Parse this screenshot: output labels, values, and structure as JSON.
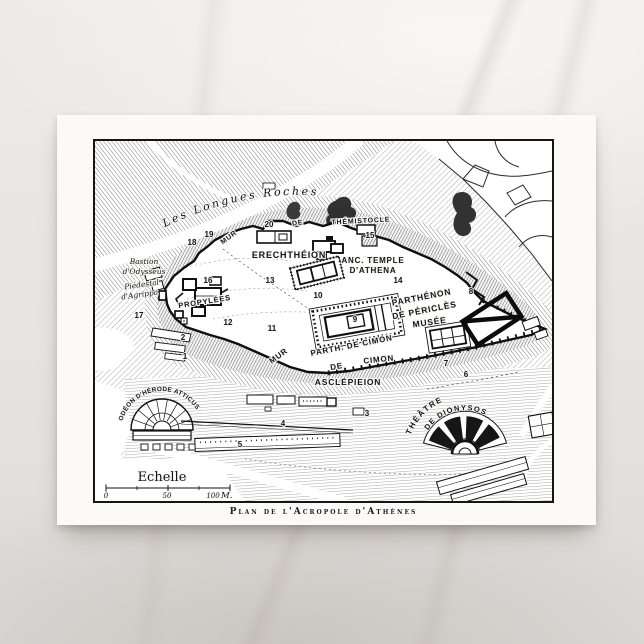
{
  "colors": {
    "marble": "#e6e3e0",
    "card": "#fbfaf7",
    "ink": "#161616"
  },
  "postcard": {
    "caption": "Plan de l'Acropole d'Athènes"
  },
  "scale": {
    "title": "Echelle",
    "t0": "0",
    "t50": "50",
    "t100": "100",
    "unit": "M."
  },
  "map": {
    "labels": {
      "longues_roches": "Les  Longues  Roches",
      "mur_t": "MUR",
      "de_t": "DE",
      "themistocle": "THÉMISTOCLE",
      "erechtheion": "ERECHTHÉION",
      "anc_temple1": "ANC. TEMPLE",
      "anc_temple2": "D'ATHENA",
      "bastion1": "Bastion",
      "bastion2": "d'Odysseus",
      "piedestal1": "Piédestal",
      "piedestal2": "d'Agrippa",
      "propylees": "PROPYLÉES",
      "parthenon1": "PARTHÉNON",
      "parthenon2": "DE PÉRICLÈS",
      "musee": "MUSÉE",
      "parth_cimon": "PARTH. DE CIMON",
      "mur_c": "MUR",
      "de_c": "DE",
      "cimon": "CIMON",
      "asclepieion": "ASCLÉPIEION",
      "odeon_herode": "ODÉON D'HÉRODE ATTICUS",
      "theatre": "THÉÂTRE",
      "theatre2": "DE DIONYSOS"
    },
    "numbers": [
      "1",
      "2",
      "3",
      "4",
      "5",
      "6",
      "7",
      "8",
      "9",
      "10",
      "11",
      "12",
      "13",
      "14",
      "15",
      "16",
      "17",
      "18",
      "19",
      "20"
    ]
  }
}
